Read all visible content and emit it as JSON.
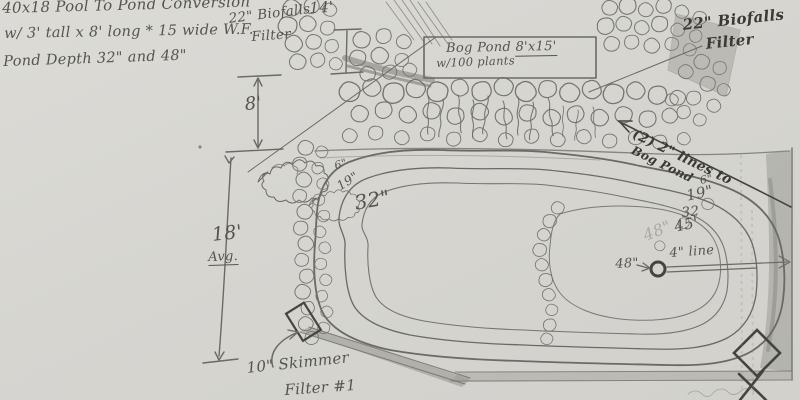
{
  "title_block": {
    "line1": "40x18 Pool To Pond Conversion",
    "line2": "w/ 3' tall x 8' long * 15 wide  W.F.",
    "line3": "Pond Depth 32\" and 48\""
  },
  "labels": {
    "biofalls_left_line1": "22\" Biofalls",
    "biofalls_left_line2": "Filter",
    "biofalls_right_line1": "22\" Biofalls",
    "biofalls_right_line2": "Filter",
    "bog_pond_name": "Bog Pond",
    "bog_pond_size": "8'x15'",
    "bog_pond_plants": "w/100 plants",
    "lines_to_bog_line1": "(2) 2\" lines to",
    "lines_to_bog_line2": "Bog Pond",
    "skimmer_line1": "10\" Skimmer",
    "skimmer_line2": "Filter #1",
    "pipe_label": "4\" line"
  },
  "dimensions": {
    "top_width": "14'",
    "upper_gap": "8'",
    "side_length": "18'",
    "side_qualifier": "Avg.",
    "drain_depth": "48\"",
    "ghost_depth": "48\""
  },
  "shelves_left": [
    "6\"",
    "19\"",
    "32\""
  ],
  "shelves_right": [
    "6\"",
    "19\"",
    "32",
    "45'"
  ],
  "colors": {
    "paper": "#d8d7d2",
    "pencil": "#6b6a64",
    "ink": "#3a3935"
  }
}
